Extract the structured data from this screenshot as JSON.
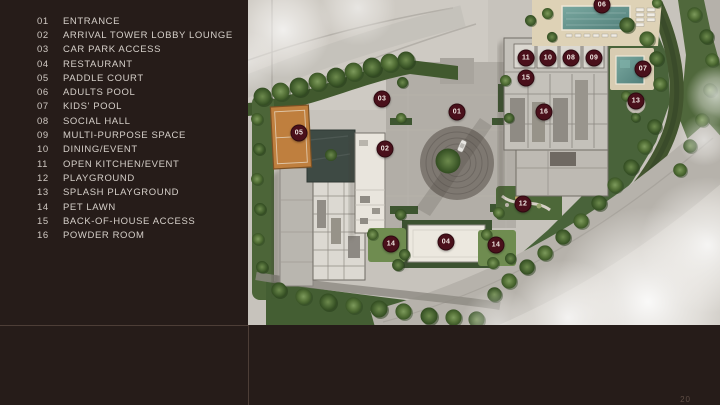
{
  "page": {
    "page_number": "20",
    "colors": {
      "background": "#261c19",
      "legend_text": "#d5cfc9",
      "marker": "#4a101b",
      "pool": "#5f8d8a",
      "court": "#bf7f3e"
    }
  },
  "legend": {
    "items": [
      {
        "num": "01",
        "label": "ENTRANCE"
      },
      {
        "num": "02",
        "label": "ARRIVAL TOWER LOBBY LOUNGE"
      },
      {
        "num": "03",
        "label": "CAR PARK ACCESS"
      },
      {
        "num": "04",
        "label": "RESTAURANT"
      },
      {
        "num": "05",
        "label": "PADDLE COURT"
      },
      {
        "num": "06",
        "label": "ADULTS POOL"
      },
      {
        "num": "07",
        "label": "KIDS' POOL"
      },
      {
        "num": "08",
        "label": "SOCIAL HALL"
      },
      {
        "num": "09",
        "label": "MULTI-PURPOSE SPACE"
      },
      {
        "num": "10",
        "label": "DINING/EVENT"
      },
      {
        "num": "11",
        "label": "OPEN KITCHEN/EVENT"
      },
      {
        "num": "12",
        "label": "PLAYGROUND"
      },
      {
        "num": "13",
        "label": "SPLASH PLAYGROUND"
      },
      {
        "num": "14",
        "label": "PET LAWN"
      },
      {
        "num": "15",
        "label": "BACK-OF-HOUSE ACCESS"
      },
      {
        "num": "16",
        "label": "POWDER ROOM"
      }
    ]
  },
  "plan": {
    "marker_color": "#4a101b",
    "markers": [
      {
        "label": "06",
        "x": 354,
        "y": 5
      },
      {
        "label": "11",
        "x": 278,
        "y": 58
      },
      {
        "label": "10",
        "x": 300,
        "y": 58
      },
      {
        "label": "08",
        "x": 323,
        "y": 58
      },
      {
        "label": "09",
        "x": 346,
        "y": 58
      },
      {
        "label": "07",
        "x": 395,
        "y": 69
      },
      {
        "label": "15",
        "x": 278,
        "y": 78
      },
      {
        "label": "13",
        "x": 388,
        "y": 101
      },
      {
        "label": "16",
        "x": 296,
        "y": 112
      },
      {
        "label": "03",
        "x": 134,
        "y": 99
      },
      {
        "label": "01",
        "x": 209,
        "y": 112
      },
      {
        "label": "05",
        "x": 51,
        "y": 133
      },
      {
        "label": "02",
        "x": 137,
        "y": 149
      },
      {
        "label": "12",
        "x": 275,
        "y": 204
      },
      {
        "label": "14",
        "x": 143,
        "y": 244
      },
      {
        "label": "04",
        "x": 198,
        "y": 242
      },
      {
        "label": "14",
        "x": 248,
        "y": 245
      }
    ]
  }
}
